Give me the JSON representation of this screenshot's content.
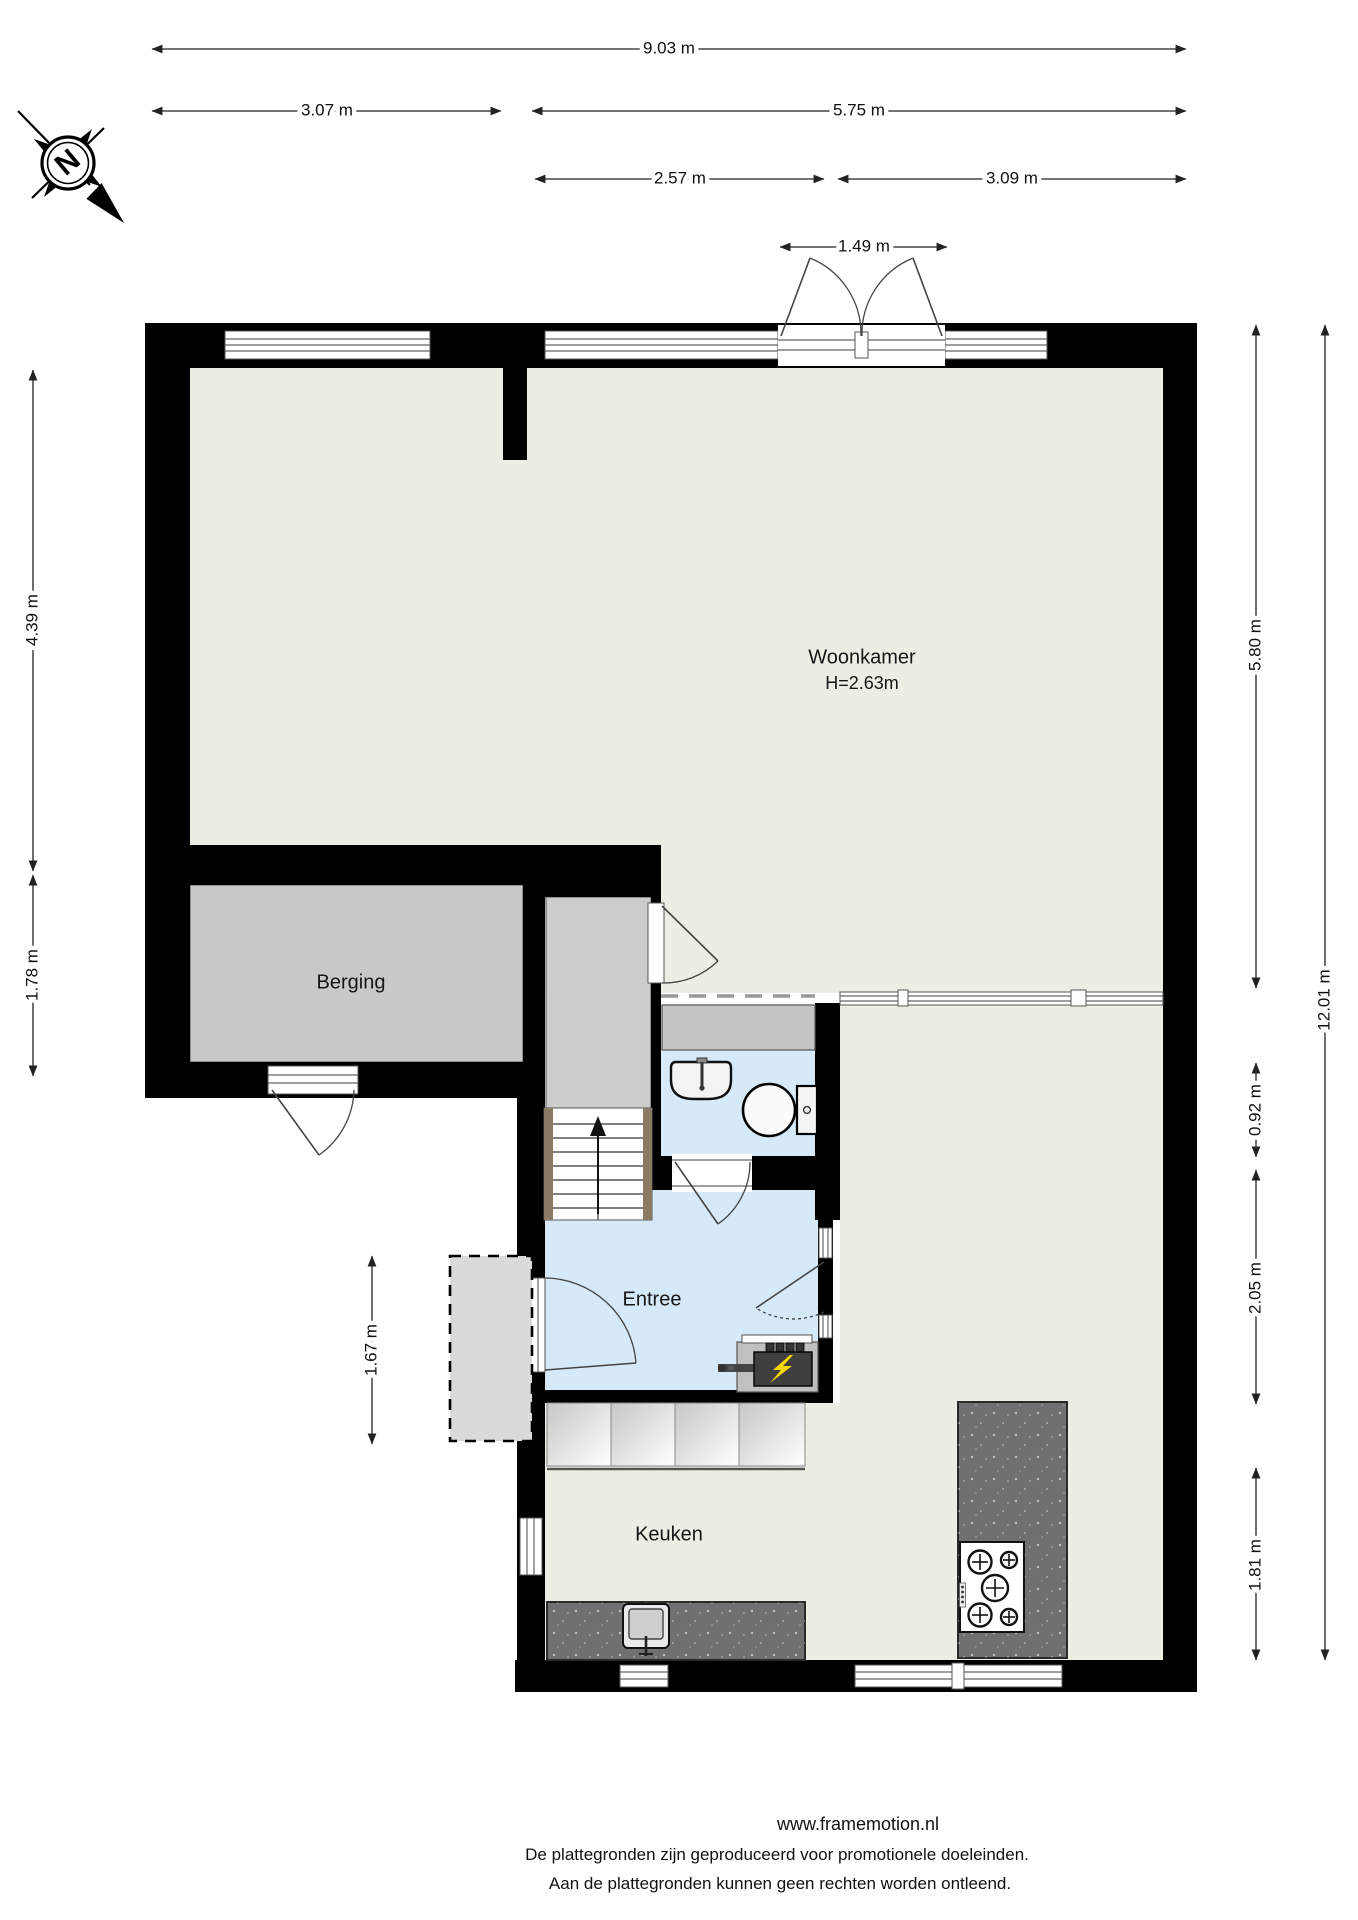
{
  "compass": {
    "north_label": "N"
  },
  "rooms": {
    "woonkamer": {
      "label": "Woonkamer",
      "ceiling_height": "H=2.63m"
    },
    "berging": {
      "label": "Berging"
    },
    "entree": {
      "label": "Entree"
    },
    "keuken": {
      "label": "Keuken"
    }
  },
  "dimensions": {
    "top": [
      "9.03 m",
      "3.07 m",
      "5.75 m",
      "2.57 m",
      "3.09 m",
      "1.49 m"
    ],
    "left": [
      "4.39 m",
      "1.78 m",
      "1.67 m"
    ],
    "right": [
      "5.80 m",
      "0.92 m",
      "2.05 m",
      "1.81 m",
      "12.01 m"
    ]
  },
  "footer": {
    "website": "www.framemotion.nl",
    "disclaimer_line1": "De plattegronden zijn geproduceerd voor promotionele doeleinden.",
    "disclaimer_line2": "Aan de plattegronden kunnen geen rechten worden ontleend."
  },
  "colors": {
    "wall": "#000000",
    "living_floor": "#edeee3",
    "kitchen_floor": "#edeee3",
    "storage_floor": "#c9c9c9",
    "hall_floor": "#cccccc",
    "entry_floor": "#d6e9f8",
    "wc_floor": "#d6e9f8",
    "counter": "#707070",
    "porch": "#dadada",
    "wardrobe": "#c5c5c5",
    "lightning": "#ffd700"
  }
}
